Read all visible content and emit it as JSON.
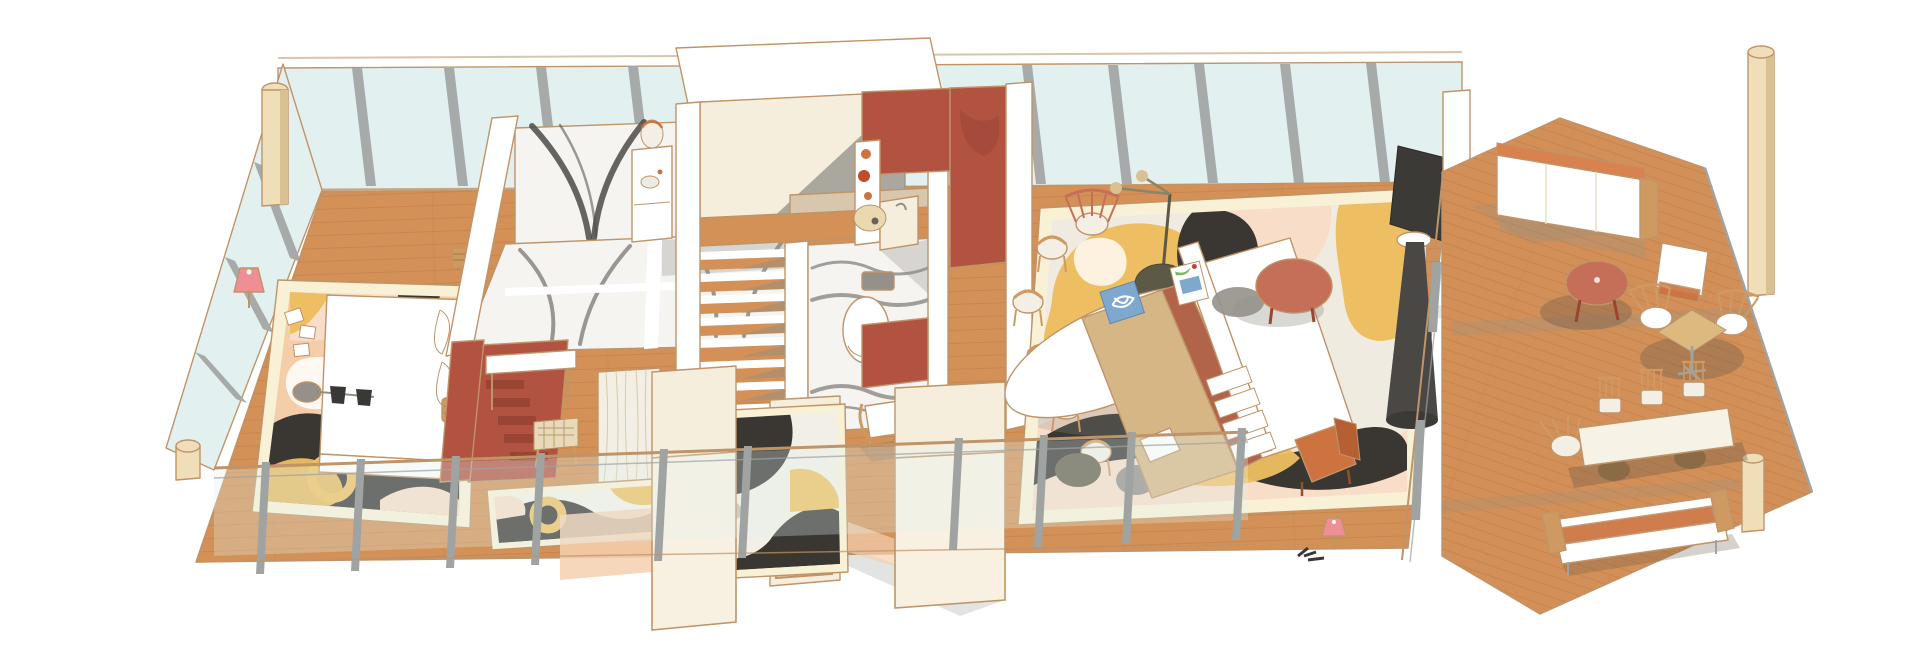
{
  "title": "Watercolor axonometric cutaway illustration of an apartment interior with wrap-around glazing and a wooden terrace",
  "scene": {
    "style": "architectural axonometric cutaway, watercolor texture, no text labels",
    "rooms": [
      {
        "name": "bedroom",
        "furniture": [
          "double-bed-white-duvet",
          "abstract-area-rug",
          "pink-floor-lamp",
          "gray-side-stool",
          "woven-basket-table",
          "loose-papers"
        ]
      },
      {
        "name": "master-bathroom",
        "features": [
          "black-white-marble-wall",
          "marble-floor-panels",
          "vanity-with-oval-mirror",
          "white-partition-walls",
          "gray-cast-shadows"
        ]
      },
      {
        "name": "dressing-room",
        "furniture": [
          "white-desk",
          "woven-top-stool",
          "pleated-curtain",
          "abstract-runner-rug"
        ],
        "features": [
          "terracotta-partition-wall",
          "terracotta-steps"
        ]
      },
      {
        "name": "staircase",
        "features": [
          "wood-treads",
          "white-stringers",
          "upper-landing",
          "shadow-wedges"
        ]
      },
      {
        "name": "guest-bathroom",
        "features": [
          "gray-veined-marble-floor",
          "wall-hung-toilet"
        ]
      },
      {
        "name": "kitchenette",
        "features": [
          "terracotta-feature-wall",
          "tall-shelf-with-orange-pots",
          "round-straw-stool"
        ]
      },
      {
        "name": "living-room",
        "furniture": [
          "oval-white-dining-table",
          "wishbone-chairs",
          "black-disc-floor-lamp",
          "tan-daybed-sofa",
          "white-modular-sofa",
          "blue-fish-art-cushions",
          "red-round-coffee-table",
          "olive-poufs",
          "orange-armchair",
          "rotating-tv-on-cone-stand",
          "small-pink-lamp"
        ],
        "features": [
          "large-abstract-rug-yellow-pink-black"
        ]
      },
      {
        "name": "entry",
        "features": [
          "arched-timber-door",
          "sectioned-cut-walls",
          "abstract-entry-rug",
          "wood-armchair-with-white-cushions"
        ]
      },
      {
        "name": "terrace",
        "furniture": [
          "white-outdoor-sofa",
          "white-lounge-chair",
          "red-round-table",
          "square-bistro-table",
          "fan-back-chairs",
          "outdoor-dining-table",
          "spindle-chairs",
          "white-orange-daybed-bench"
        ],
        "features": [
          "diagonal-wood-deck",
          "wire-railing",
          "tall-timber-columns"
        ]
      }
    ],
    "envelope": [
      "floor-to-ceiling-glazing",
      "gray-steel-mullions",
      "glass-balustrade-with-steel-posts",
      "timber-corner-columns",
      "white-roof-slab-over-stair"
    ]
  },
  "palette": {
    "bg": "#ffffff",
    "outline": "#bf9469",
    "glass": "#e2f1f0",
    "glassDeep": "#d4eaea",
    "mullion": "#a6aaa8",
    "steel": "#9fa3a2",
    "wood": "#d39057",
    "woodLine": "#b97a41",
    "deck": "#d29058",
    "deckLine": "#bc7a44",
    "redWall": "#b25342",
    "redDeep": "#9a4433",
    "cream": "#f6eedd",
    "creamDeep": "#e9dcc4",
    "beigeBar": "#d8c6ad",
    "white": "#ffffff",
    "marble": "#f5f4f1",
    "vein": "#4e4a47",
    "grayShadow": "#8f8f88",
    "softShadow": "#6b5a49",
    "rugBase": "#f0ebe0",
    "rugYellow": "#edbf62",
    "rugPeach": "#f4d0b0",
    "rugPink": "#f8ddc9",
    "rugBlack": "#3a3733",
    "rugBorder": "#f8f1d6",
    "rugEdge": "#8a6b4a",
    "bedRug": "#f4cda9",
    "sofaTan": "#d7b686",
    "sofaRust": "#b2644a",
    "pouf": "#66604c",
    "poufGray": "#95908a",
    "poufBrown": "#8a6b46",
    "blue": "#7ea8ce",
    "orange": "#cd7340",
    "red2": "#c66f58",
    "pink": "#ee8f96",
    "chairWood": "#cf9a62",
    "dark": "#3a3835",
    "timber": "#efdeb8",
    "timberDeep": "#d9c193",
    "linen": "#f4efe4"
  }
}
